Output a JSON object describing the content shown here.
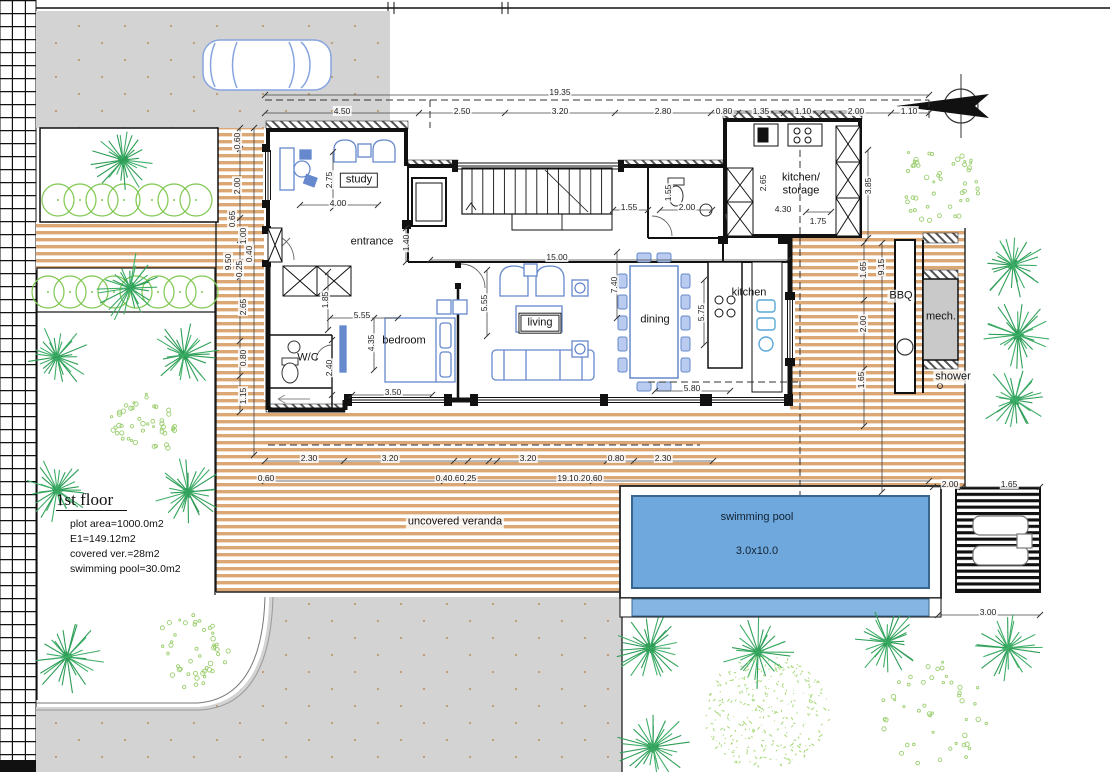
{
  "title": "1st floor plan",
  "colors": {
    "veranda_stripe": "#dba875",
    "pool_blue": "#6fa8dc",
    "pool_blue_light": "#84b5e3",
    "driveway_gray": "#d3d3d3",
    "plant_dark_green": "#2e9e57",
    "plant_light_green": "#9ccf70",
    "furniture_blue": "#6688cc",
    "mech_gray": "#c9c9c9"
  },
  "info": {
    "title": "1st floor",
    "lines": [
      "plot area=1000.0m2",
      "E1=149.12m2",
      "covered ver.=28m2",
      "swimming pool=30.0m2"
    ]
  },
  "pool": {
    "label": "swimming pool",
    "size": "3.0x10.0"
  },
  "labels": [
    {
      "id": "study",
      "text": "study",
      "x": 359,
      "y": 180,
      "box": "single"
    },
    {
      "id": "entrance",
      "text": "entrance",
      "x": 372,
      "y": 242,
      "halo": true
    },
    {
      "id": "wc",
      "text": "W/C",
      "x": 308,
      "y": 358
    },
    {
      "id": "bedroom",
      "text": "bedroom",
      "x": 404,
      "y": 341
    },
    {
      "id": "living",
      "text": "living",
      "x": 540,
      "y": 323,
      "box": "double"
    },
    {
      "id": "dining",
      "text": "dining",
      "x": 655,
      "y": 320
    },
    {
      "id": "kitchen",
      "text": "kitchen",
      "x": 749,
      "y": 293
    },
    {
      "id": "kitchen-storage",
      "text": "kitchen/\nstorage",
      "x": 801,
      "y": 184
    },
    {
      "id": "bbq",
      "text": "BBQ",
      "x": 901,
      "y": 296,
      "halo": true
    },
    {
      "id": "mech",
      "text": "mech.",
      "x": 941,
      "y": 317
    },
    {
      "id": "shower",
      "text": "shower",
      "x": 953,
      "y": 377,
      "halo": true
    },
    {
      "id": "uncovered-veranda",
      "text": "uncovered veranda",
      "x": 455,
      "y": 522,
      "halo": true
    }
  ],
  "dims": [
    {
      "t": "19.35",
      "x": 560,
      "y": 92
    },
    {
      "t": "4.50",
      "x": 342,
      "y": 111
    },
    {
      "t": "2.50",
      "x": 462,
      "y": 111
    },
    {
      "t": "3.20",
      "x": 560,
      "y": 111
    },
    {
      "t": "2.80",
      "x": 663,
      "y": 111
    },
    {
      "t": "0.80",
      "x": 724,
      "y": 111
    },
    {
      "t": "1.35",
      "x": 761,
      "y": 111
    },
    {
      "t": "1.10",
      "x": 803,
      "y": 111
    },
    {
      "t": "2.00",
      "x": 856,
      "y": 111
    },
    {
      "t": "1.10",
      "x": 909,
      "y": 111
    },
    {
      "t": "0.60",
      "x": 237,
      "y": 141,
      "r": 90
    },
    {
      "t": "2.00",
      "x": 237,
      "y": 186,
      "r": 90
    },
    {
      "t": "0.65",
      "x": 232,
      "y": 219,
      "r": 90
    },
    {
      "t": "1.00",
      "x": 243,
      "y": 236,
      "r": 90
    },
    {
      "t": "0.40",
      "x": 249,
      "y": 254,
      "r": 90
    },
    {
      "t": "9.50",
      "x": 228,
      "y": 262,
      "r": 90
    },
    {
      "t": "0.25",
      "x": 239,
      "y": 269,
      "r": 90
    },
    {
      "t": "2.65",
      "x": 243,
      "y": 307,
      "r": 90
    },
    {
      "t": "0.80",
      "x": 243,
      "y": 358,
      "r": 90
    },
    {
      "t": "1.15",
      "x": 243,
      "y": 396,
      "r": 90
    },
    {
      "t": "2.75",
      "x": 329,
      "y": 180,
      "r": 90
    },
    {
      "t": "4.00",
      "x": 338,
      "y": 203
    },
    {
      "t": "1.40",
      "x": 406,
      "y": 243,
      "r": 90
    },
    {
      "t": "1.55",
      "x": 629,
      "y": 207
    },
    {
      "t": "1.55",
      "x": 668,
      "y": 193,
      "r": 90
    },
    {
      "t": "2.00",
      "x": 687,
      "y": 207
    },
    {
      "t": "2.65",
      "x": 763,
      "y": 183,
      "r": 90
    },
    {
      "t": "4.30",
      "x": 783,
      "y": 209
    },
    {
      "t": "1.75",
      "x": 818,
      "y": 221
    },
    {
      "t": "3.85",
      "x": 868,
      "y": 186,
      "r": 90
    },
    {
      "t": "15.00",
      "x": 557,
      "y": 257
    },
    {
      "t": "5.55",
      "x": 362,
      "y": 315
    },
    {
      "t": "1.85",
      "x": 325,
      "y": 300,
      "r": 90
    },
    {
      "t": "4.35",
      "x": 371,
      "y": 343,
      "r": 90
    },
    {
      "t": "2.40",
      "x": 329,
      "y": 368,
      "r": 90
    },
    {
      "t": "3.50",
      "x": 393,
      "y": 392
    },
    {
      "t": "5.55",
      "x": 484,
      "y": 303,
      "r": 90
    },
    {
      "t": "7.40",
      "x": 614,
      "y": 285,
      "r": 90
    },
    {
      "t": "5.75",
      "x": 701,
      "y": 313,
      "r": 90
    },
    {
      "t": "5.80",
      "x": 692,
      "y": 388
    },
    {
      "t": "1.65",
      "x": 863,
      "y": 270,
      "r": 90
    },
    {
      "t": "9.15",
      "x": 881,
      "y": 267,
      "r": 90
    },
    {
      "t": "2.00",
      "x": 863,
      "y": 324,
      "r": 90
    },
    {
      "t": "1.65",
      "x": 861,
      "y": 380,
      "r": 90
    },
    {
      "t": "2.30",
      "x": 309,
      "y": 458
    },
    {
      "t": "3.20",
      "x": 390,
      "y": 458
    },
    {
      "t": "3.20",
      "x": 528,
      "y": 458
    },
    {
      "t": "0.80",
      "x": 616,
      "y": 458
    },
    {
      "t": "2.30",
      "x": 663,
      "y": 458
    },
    {
      "t": "0.60",
      "x": 266,
      "y": 478
    },
    {
      "t": "0.40",
      "x": 444,
      "y": 478
    },
    {
      "t": "0.60",
      "x": 456,
      "y": 478
    },
    {
      "t": "0.25",
      "x": 468,
      "y": 478
    },
    {
      "t": "19.10",
      "x": 568,
      "y": 478
    },
    {
      "t": "0.25",
      "x": 582,
      "y": 478
    },
    {
      "t": "0.60",
      "x": 594,
      "y": 478
    },
    {
      "t": "2.00",
      "x": 950,
      "y": 484
    },
    {
      "t": "1.65",
      "x": 1009,
      "y": 484
    },
    {
      "t": "3.00",
      "x": 988,
      "y": 612
    }
  ]
}
